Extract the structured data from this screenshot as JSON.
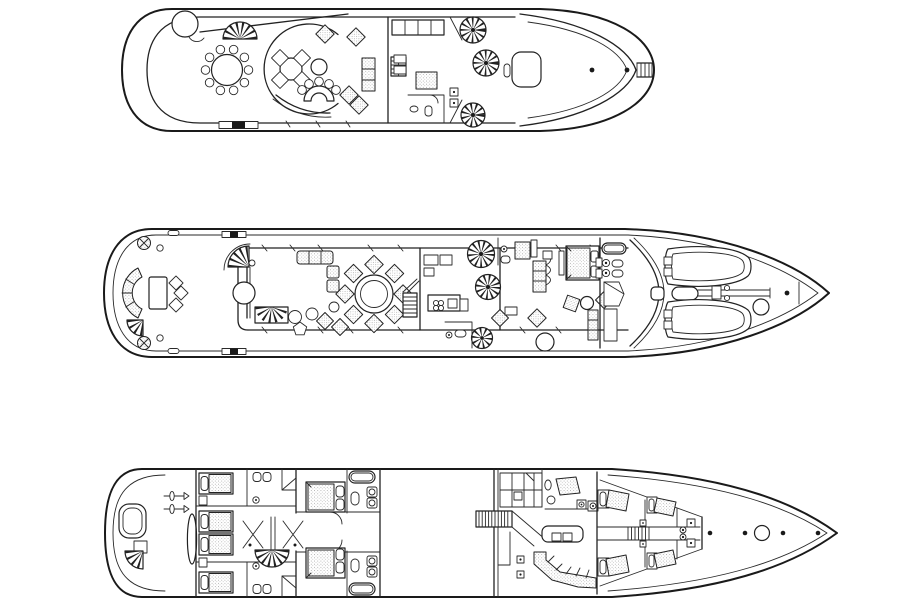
{
  "meta": {
    "description": "Black-and-white architectural deck plans of a motor yacht, three decks shown stacked in top view",
    "background_color": "#ffffff",
    "line_color": "#222222",
    "upholstery_stipple_color": "#999999",
    "deck_count": 3
  },
  "decks": [
    {
      "id": "sun-deck",
      "name": "Sun / bridge deck plan",
      "features": [
        "spa-circle",
        "awning-line",
        "fan-staircase",
        "round-dining-table-ten-chairs",
        "sky-lounge-round-wall",
        "lounge-table-four-chairs",
        "cocktail-table",
        "curved-bar-five-stools",
        "four-upholstered-ottomans",
        "upholstered-settee",
        "companionway-stairs",
        "wheelhouse",
        "helm-console",
        "chart-settee",
        "three-spiral-staircases",
        "sun-roof-hatch",
        "foredeck-arcs",
        "two-deck-dots",
        "bow-ladder",
        "boarding-gate-marker"
      ]
    },
    {
      "id": "main-deck",
      "name": "Main deck plan",
      "features": [
        "aft-quarter-stairs",
        "two-mooring-winches",
        "cleats",
        "two-boarding-gates",
        "curved-aft-settee",
        "aft-table-three-chairs",
        "interior-curved-stair",
        "round-hall-table",
        "lower-fan-stair",
        "salon-sofa",
        "two-armchairs",
        "lounge-cluster",
        "dining-table-eight-chairs",
        "mid-staircase",
        "galley",
        "three-spiral-staircases",
        "day-head",
        "powder-room",
        "master-lobby",
        "master-wardrobe",
        "master-king-bed",
        "master-sitting-area",
        "master-bath-tub-sinks-toilets-shower",
        "curved-windshield",
        "two-tenders-on-foredeck",
        "tender-crane",
        "deck-circle",
        "bow-dot",
        "bow-staff"
      ]
    },
    {
      "id": "lower-deck",
      "name": "Lower deck plan",
      "features": [
        "transom-platform-door",
        "stern-quarter-stairs",
        "twin-propellers",
        "rudder-skeg",
        "four-guest-twin-beds",
        "two-guest-bathrooms",
        "lobby-double-doors",
        "lobby-fan-staircase",
        "two-vip-queen-beds",
        "two-vip-bathrooms-with-tubs",
        "empty-engine-room",
        "crew-staircase",
        "store-lockers",
        "captain-cabin",
        "laundry-appliances",
        "crew-mess-table",
        "crew-mess-diagonal-bench",
        "two-stools",
        "four-crew-bunks",
        "companionway-ladder",
        "windlass-gypsies",
        "forepeak-dots",
        "chain-locker-circle"
      ]
    }
  ]
}
